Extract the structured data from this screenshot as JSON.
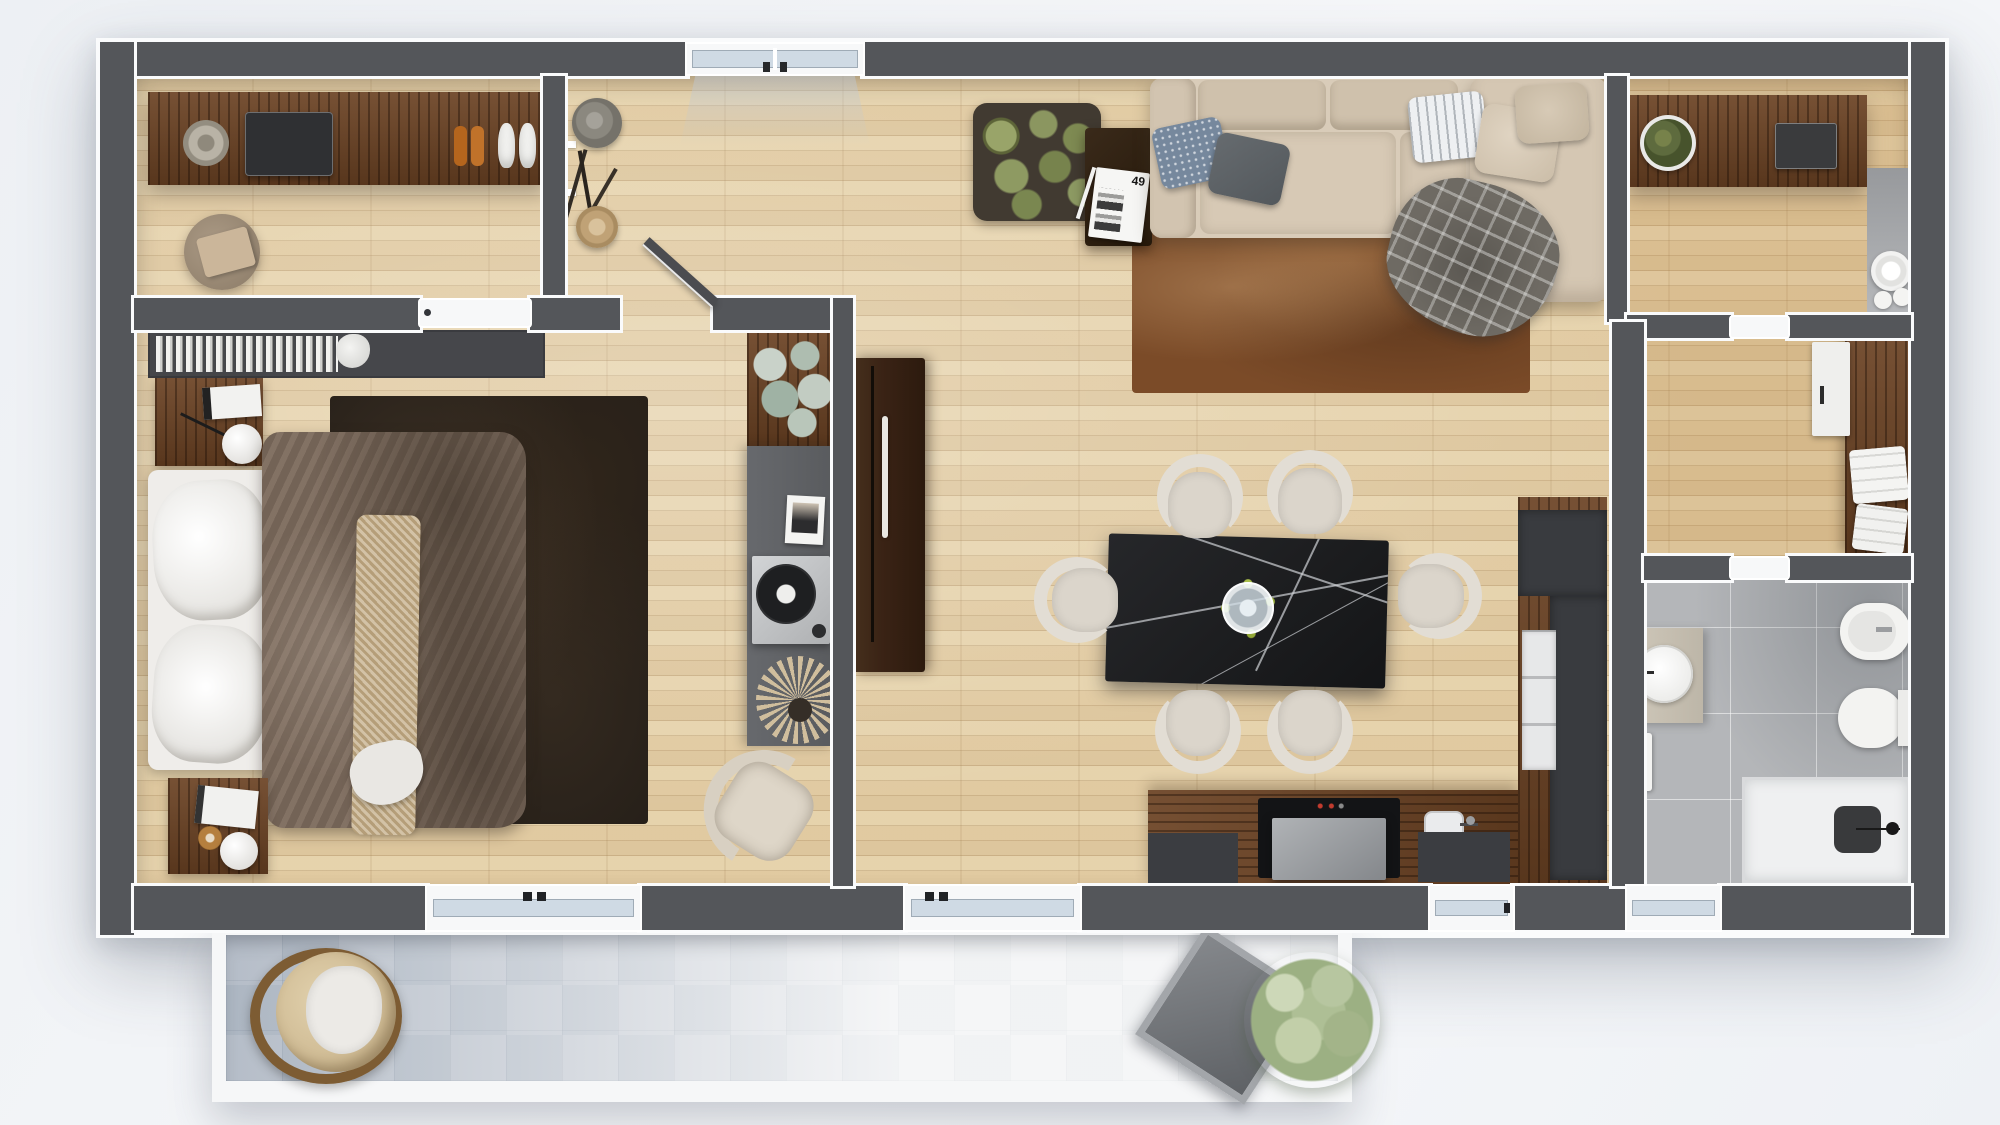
{
  "palette": {
    "wall": "#54565a",
    "wall_outline": "#fafbfc",
    "parquet": "#e4d1ab",
    "walnut": "#6b4223",
    "tile": "#b4b6b9",
    "stone": "#d2d6db",
    "sofa": "#d9ccb9",
    "chair": "#dbd5cb",
    "rug_living": "#7b4b28",
    "rug_bedroom": "#241e18",
    "duvet": "#7c6a5c",
    "mattress": "#efedea",
    "throw": "#c4ae88",
    "blanket": "#6e6a63",
    "marble": "#1c1d1f",
    "cabinet_brown": "#3a2315",
    "sideboard_gray": "#595b5e",
    "appliance": "#3b3d41",
    "fixture": "#f3f3f1",
    "glass": "#cfdae4",
    "succulent": "#87935c",
    "bush": "#b7c6a2"
  },
  "living_room": {
    "magazine_label": "49",
    "items": [
      "sofa",
      "pillows",
      "plaid-blanket",
      "area-rug",
      "side-table",
      "magazine",
      "succulent-planter",
      "coat-stand",
      "hats",
      "dining-table",
      "dining-chairs",
      "glass-vase",
      "tall-brown-cabinet",
      "wall-window"
    ]
  },
  "bedroom": {
    "items": [
      "double-bed",
      "pillows",
      "brown-duvet",
      "knit-throw",
      "nightstand-top",
      "nightstand-bottom",
      "sphere-lamps",
      "book-shelf",
      "dark-rug",
      "gray-sideboard",
      "record-player",
      "pampas-vase",
      "magnolia-plant",
      "boucle-armchair",
      "open-door"
    ]
  },
  "dressing_room": {
    "items": [
      "wardrobe-strip",
      "hat",
      "storage-tray",
      "sandals",
      "sneakers",
      "pouf-with-clothes"
    ]
  },
  "entry": {
    "items": [
      "walnut-sideboard",
      "potted-plant",
      "tray",
      "plate-set",
      "gray-niche"
    ]
  },
  "hallway": {
    "items": [
      "walnut-cabinet",
      "white-box",
      "towel-stacks",
      "doors"
    ]
  },
  "bathroom": {
    "items": [
      "vanity-with-round-sink",
      "bidet",
      "toilet",
      "towel-rail",
      "walk-in-shower",
      "shower-mat",
      "gray-tiles"
    ]
  },
  "kitchen": {
    "items": [
      "wood-counter",
      "cooktop",
      "extractor-hood",
      "sink",
      "dark-worktops",
      "tall-unit",
      "open-shelf"
    ]
  },
  "balcony": {
    "items": [
      "stone-tiles",
      "hanging-egg-chair",
      "square-table",
      "green-bush",
      "white-parapet"
    ]
  }
}
